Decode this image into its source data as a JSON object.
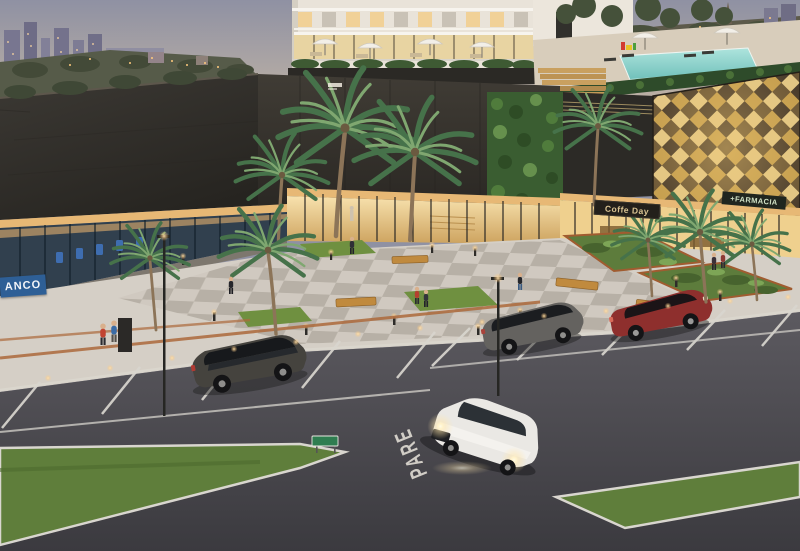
{
  "signs": {
    "bank": "ANCO",
    "coffee_shop": "Coffe Day",
    "pharmacy": "+FARMACIA"
  },
  "road": {
    "stop_marking": "PARE"
  },
  "palette": {
    "sky-top": "#8f91a3",
    "sky-horizon": "#ccb9a5",
    "hill": "#565b49",
    "roof-dark": "#33302b",
    "facade-dark": "#38342f",
    "gold-facade": "#c59e4e",
    "living-wall": "#3f6433",
    "window-warm": "#f2d295",
    "plaza-light": "#d5cfc6",
    "plaza-dark": "#b4ada2",
    "grass": "#5f7e3b",
    "asphalt": "#4a484d",
    "marking-white": "#dcd8d0",
    "corten": "#a05c30",
    "pool": "#8fd6cf",
    "sign-blue": "#2e5f96",
    "sign-dark": "#23201b",
    "sign-text-gold": "#d9c392",
    "pharmacy-green": "#cfe0c4",
    "car-red": "#8e2f2d",
    "car-white": "#eae8e4",
    "car-gray": "#64625f",
    "car-dark": "#403e39",
    "umbrella": "#f2efe8",
    "palm-green": "#46724a",
    "lamp-glow": "#ffd296"
  }
}
